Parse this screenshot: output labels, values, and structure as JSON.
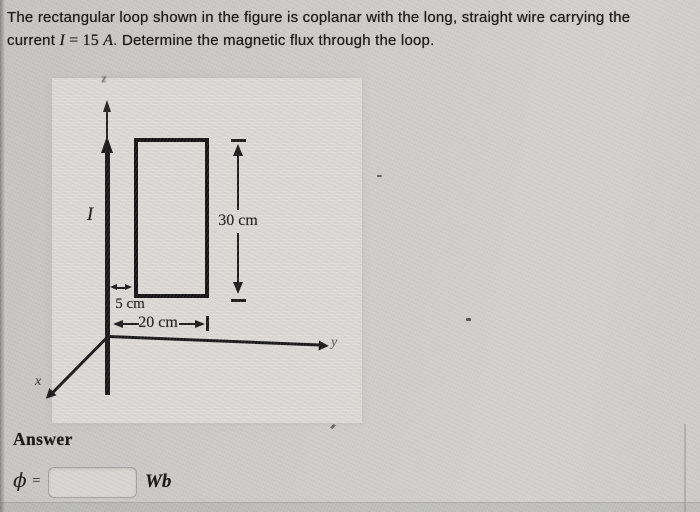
{
  "problem": {
    "line1": "The rectangular loop shown in the figure is coplanar with the long, straight wire carrying the",
    "line2_pre": "current ",
    "current_symbol": "I",
    "current_value": " = 15 ",
    "current_unit": "A",
    "line2_post": ". Determine the magnetic flux through the loop."
  },
  "figure": {
    "z_axis_label": "z",
    "y_axis_label": "y",
    "x_axis_label": "x",
    "current_label": "I",
    "height_dimension": "30 cm",
    "offset_dimension": "5 cm",
    "width_dimension": "20 cm"
  },
  "answer": {
    "heading": "Answer",
    "flux_symbol": "ϕ",
    "equals_sign": "=",
    "input_value": "",
    "unit": "Wb"
  },
  "colors": {
    "ink": "#1a1a1a",
    "paper": "#cbcac8",
    "figure_panel": "#d8d7d4"
  }
}
